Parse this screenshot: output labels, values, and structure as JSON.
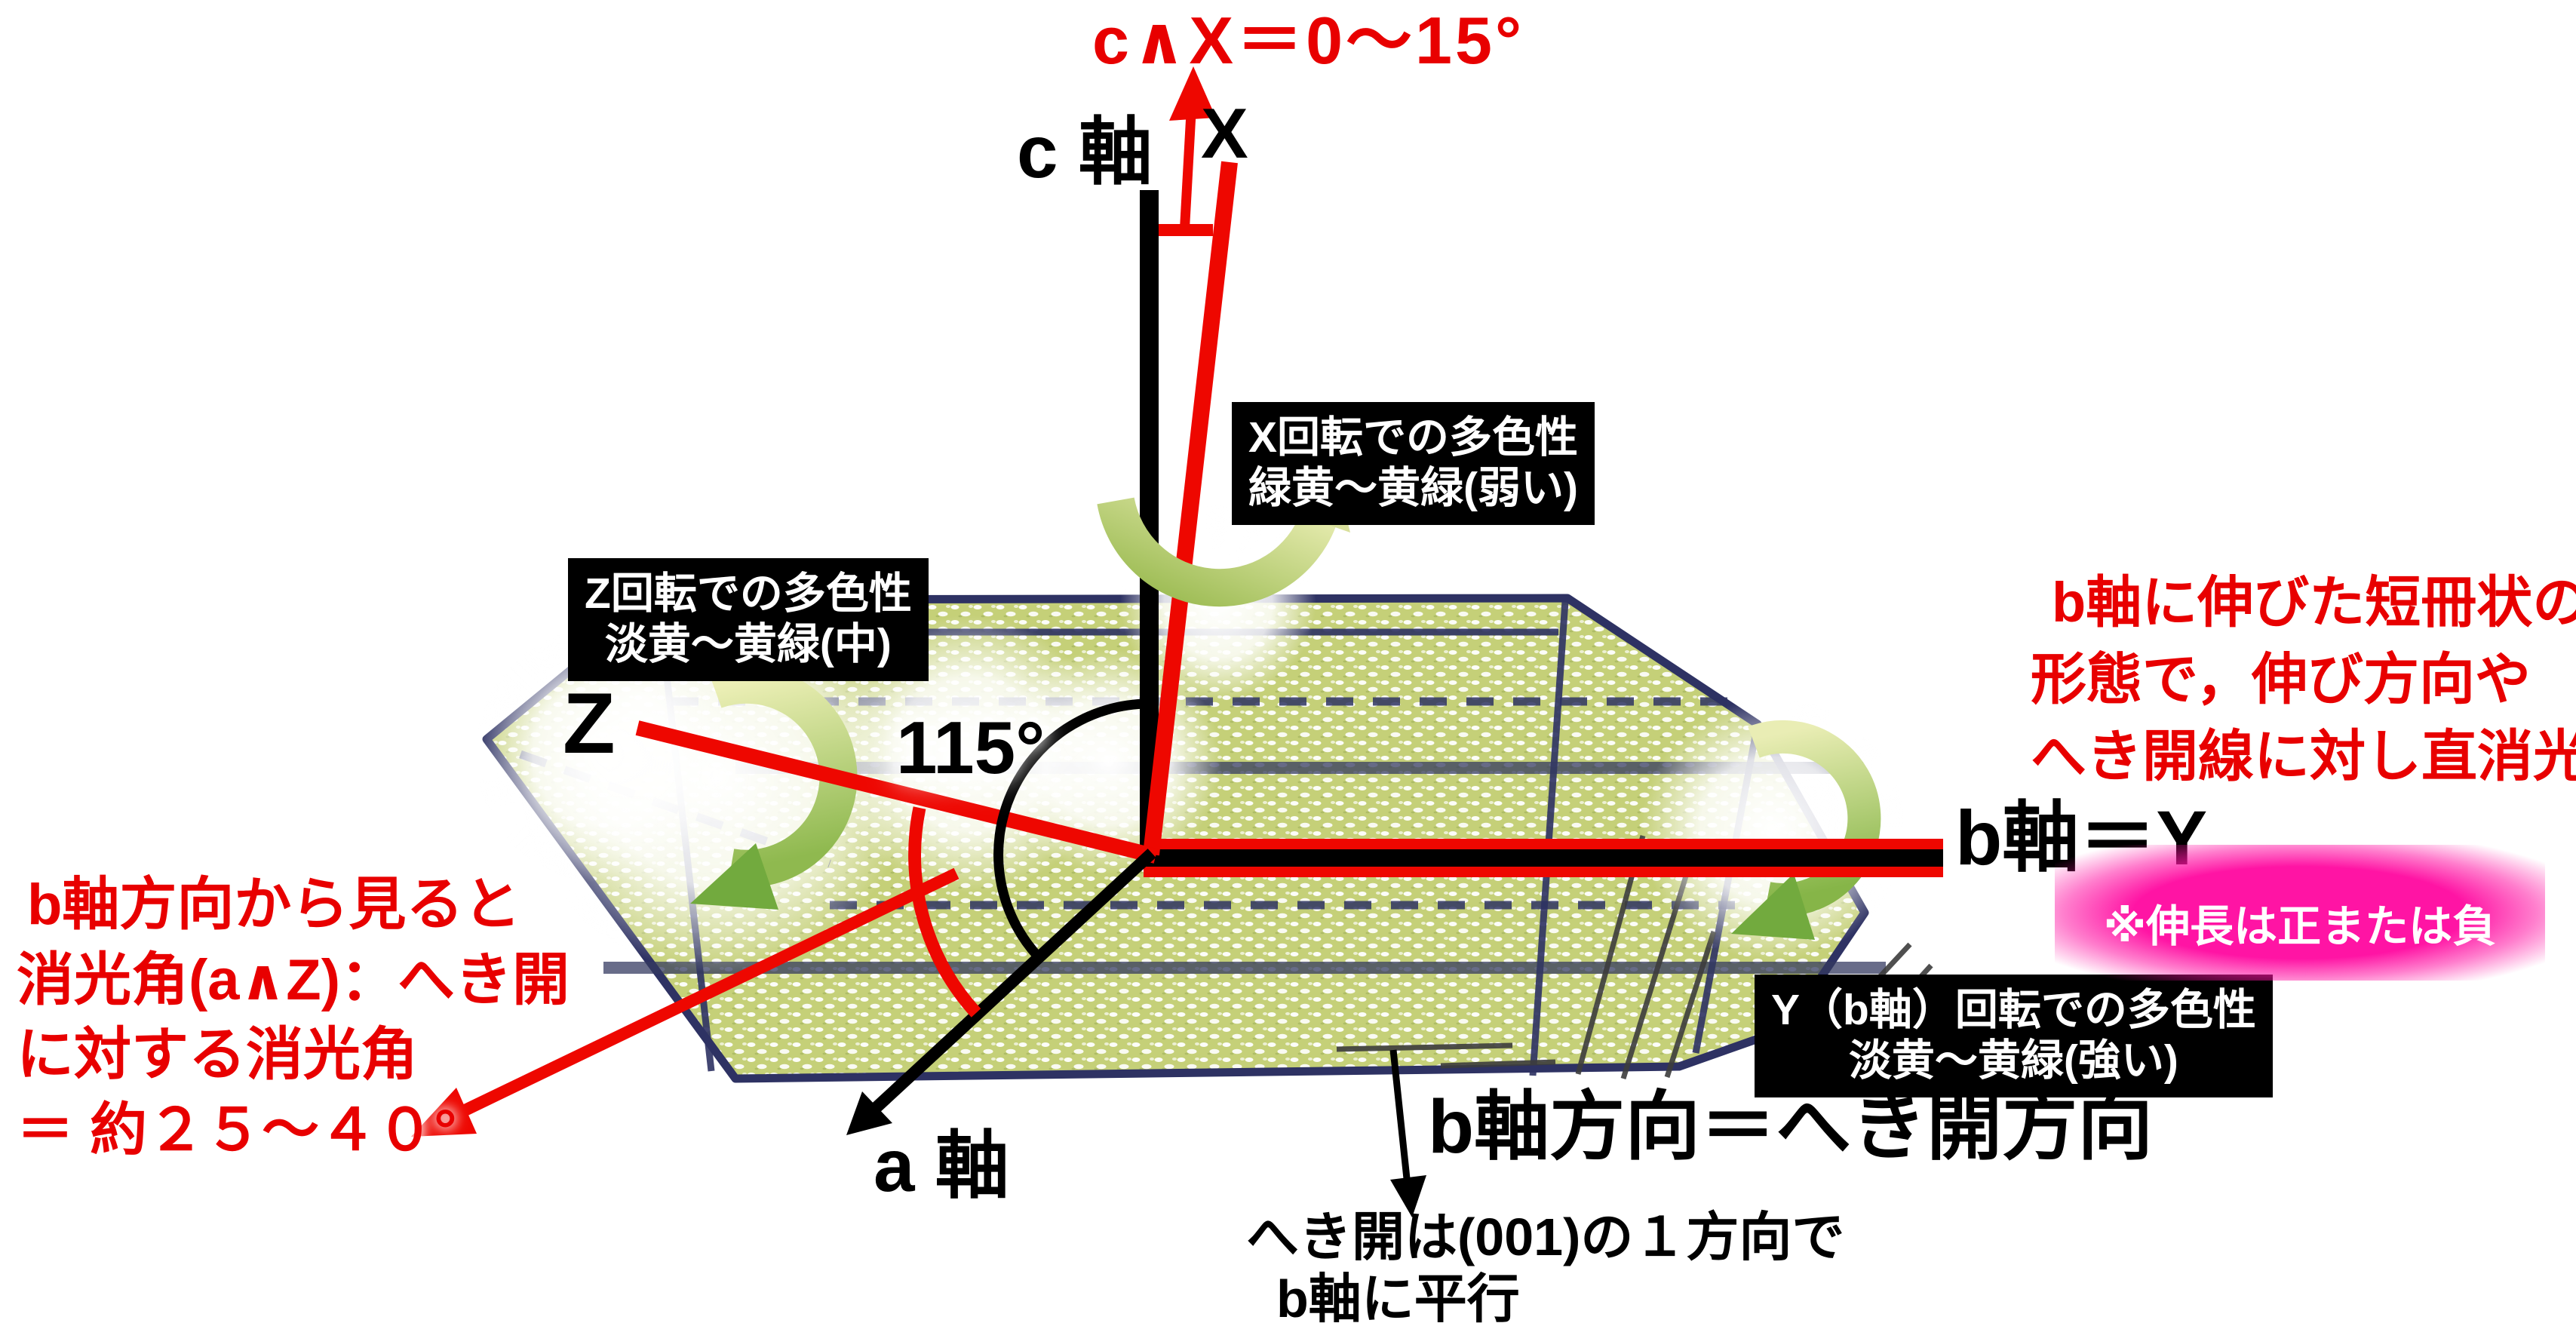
{
  "title": "c∧X＝0～15°",
  "axis_labels": {
    "c": "c 軸",
    "x": "X",
    "z": "Z",
    "a": "a 軸",
    "b": "b軸＝Y",
    "beta_angle": "115°"
  },
  "rotation_boxes": {
    "x": {
      "line1": "X回転での多色性",
      "line2": "緑黄～黄緑(弱い)"
    },
    "z": {
      "line1": "Z回転での多色性",
      "line2": "淡黄～黄緑(中)"
    },
    "y": {
      "line1": "Y（b軸）回転での多色性",
      "line2": "淡黄～黄緑(強い)"
    }
  },
  "annotations": {
    "habit": {
      "line1": "b軸に伸びた短冊状の",
      "line2": "形態で，伸び方向や",
      "line3": "へき開線に対し直消光"
    },
    "extinction": {
      "line1": "b軸方向から見ると",
      "line2": "消光角(a∧Z)：へき開",
      "line3": "に対する消光角",
      "line4": "＝ 約２５～４０°"
    },
    "elongation": "※伸長は正または負",
    "cleavage_direction": "b軸方向＝へき開方向",
    "cleavage": {
      "line1": "へき開は(001)の１方向で",
      "line2": "b軸に平行"
    }
  },
  "colors": {
    "annotation_red": "#e80000",
    "crystal_fill": "#c5d078",
    "crystal_outline": "#2e3263",
    "rotation_arrow_light": "#ecefb6",
    "rotation_arrow_dark": "#8fb94f",
    "highlight_pink": "#ff14a4",
    "box_background": "#000000",
    "box_text": "#ffffff"
  }
}
